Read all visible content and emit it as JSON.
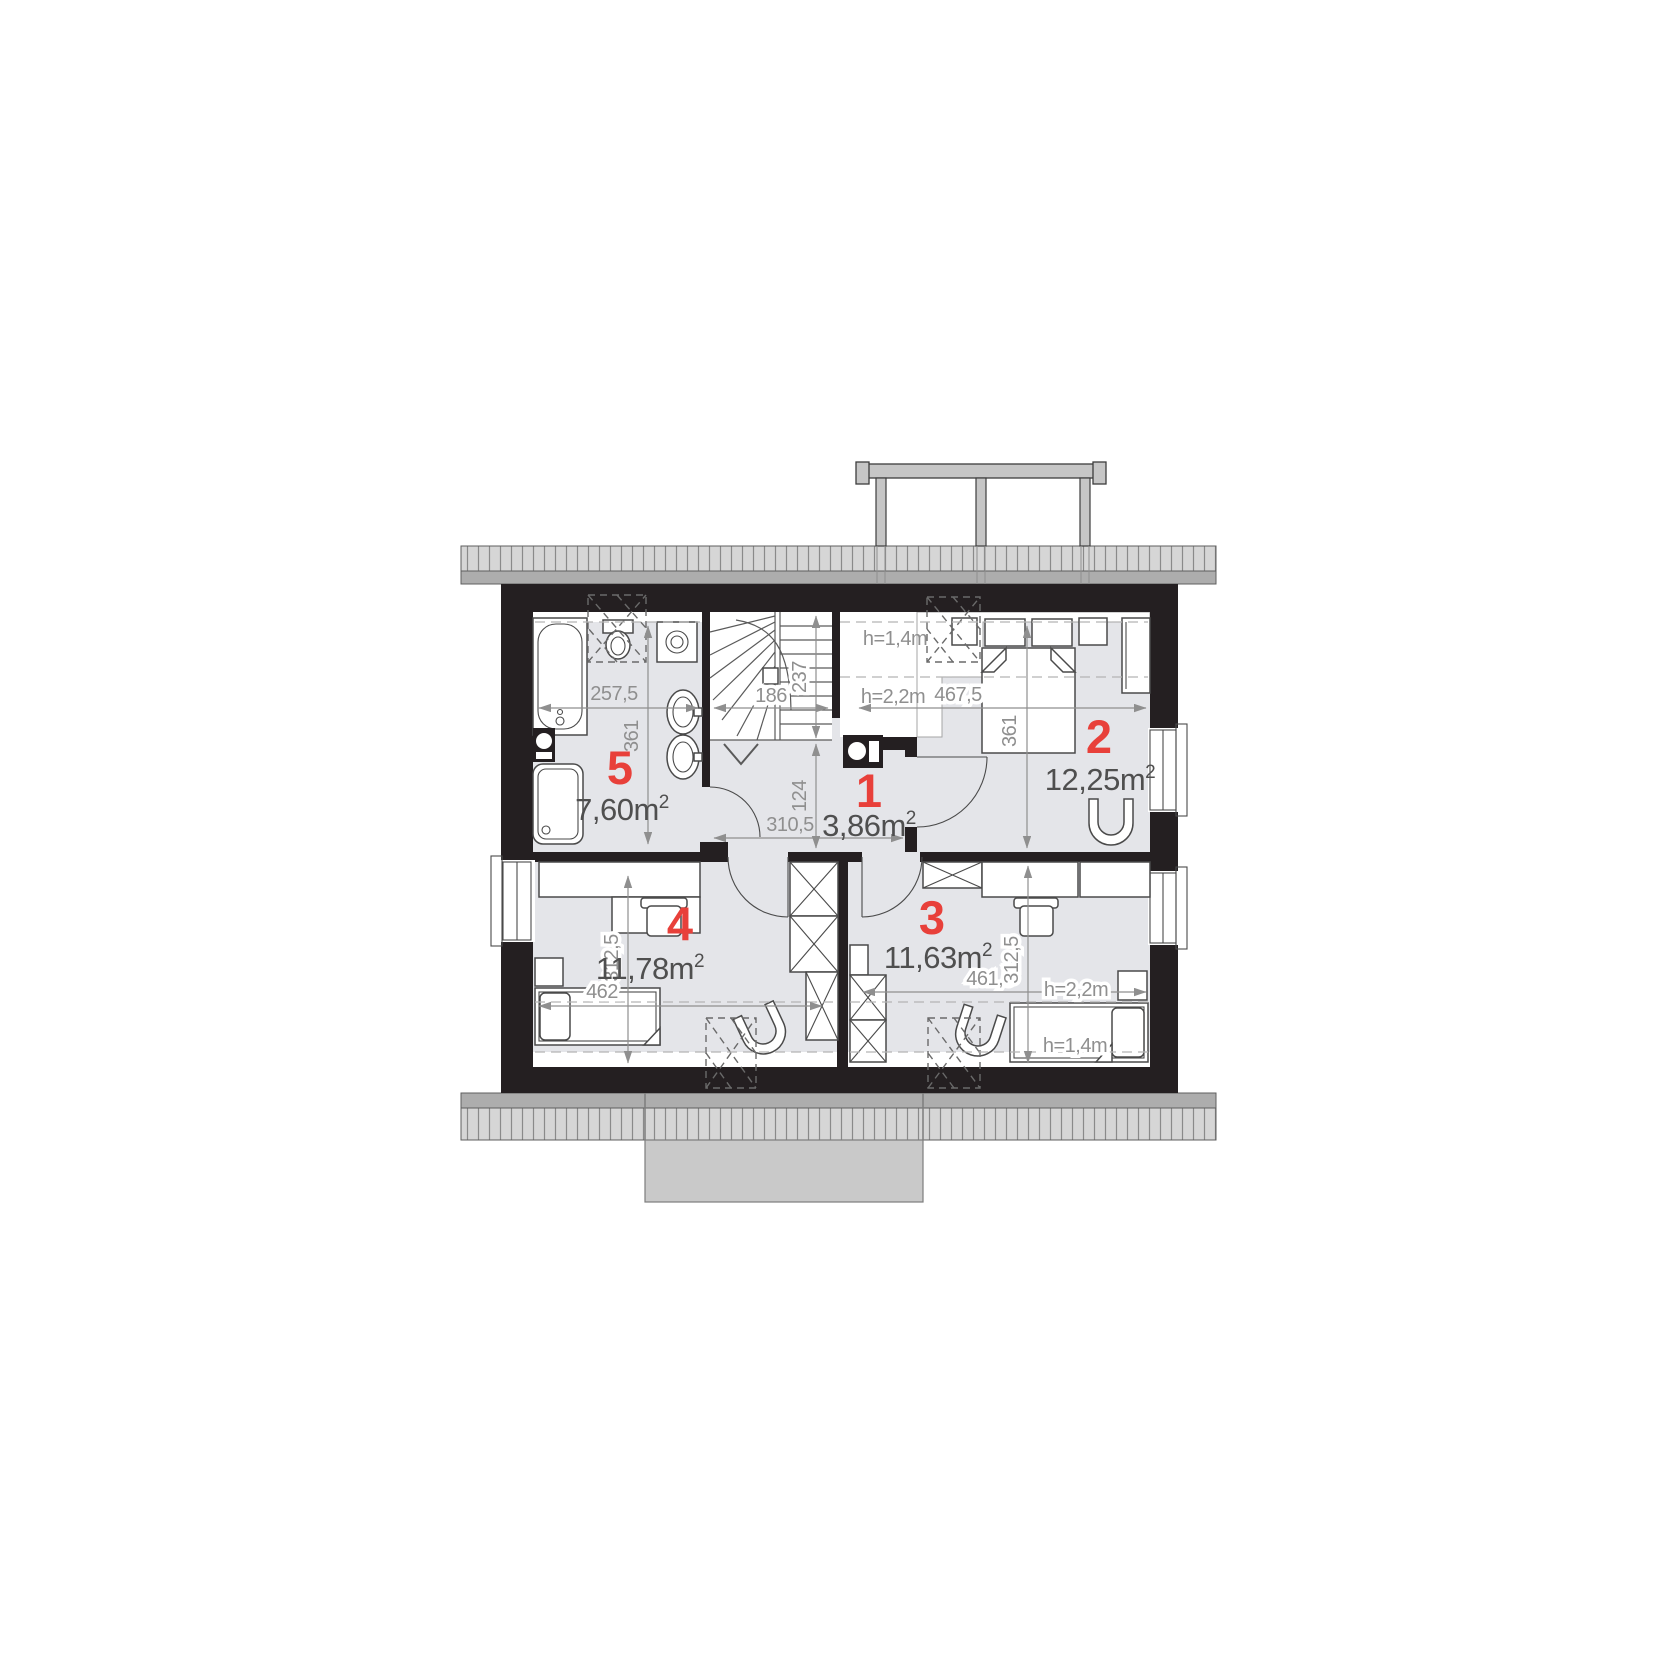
{
  "theme": {
    "wall": "#241f21",
    "floor": "#e4e5e9",
    "accent": "#e8403a",
    "dim_text": "#8f8f8f",
    "area_text": "#4f4f4f",
    "furniture": "#4a4a4a",
    "eave_fill": "#d6d6d6",
    "eave_band": "#adadad",
    "chimney": "#c9c9c9",
    "balcony": "#c6c6c6",
    "zone_dash": "#b5b5b5"
  },
  "rooms": [
    {
      "number": "1",
      "area": "3,86m",
      "area_sup": "2"
    },
    {
      "number": "2",
      "area": "12,25m",
      "area_sup": "2"
    },
    {
      "number": "3",
      "area": "11,63m",
      "area_sup": "2"
    },
    {
      "number": "4",
      "area": "11,78m",
      "area_sup": "2"
    },
    {
      "number": "5",
      "area": "7,60m",
      "area_sup": "2"
    }
  ],
  "dims": {
    "bath_width": "257,5",
    "bath_depth": "361",
    "stair_width": "186",
    "stair_depth": "237",
    "hall_depth": "124",
    "hall_width": "310,5",
    "room2_width": "467,5",
    "room2_bed": "361",
    "room4_depth": "312,5",
    "room4_width": "462",
    "room3_width": "461,5",
    "room3_depth": "312,5"
  },
  "heights": {
    "h_low": "h=1,4m",
    "h_mid": "h=2,2m"
  }
}
